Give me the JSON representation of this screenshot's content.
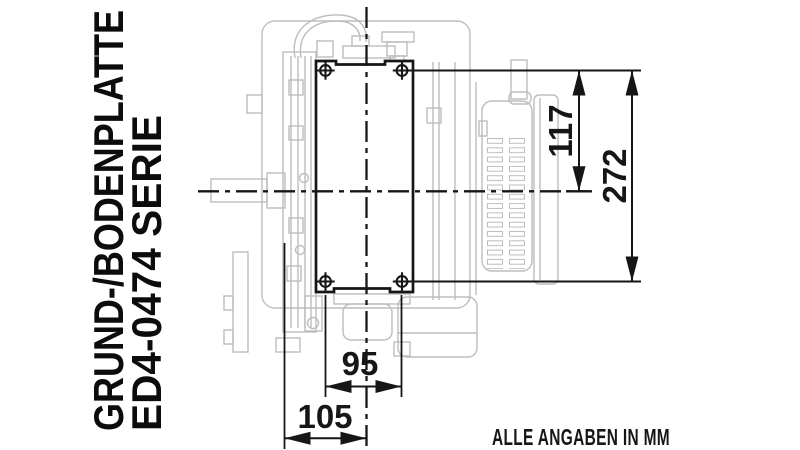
{
  "drawing_title": {
    "line1": "GRUND-/BODENPLATTE",
    "line2": "ED4-0474 SERIE"
  },
  "dimensions": {
    "bolt_top_to_crank_center": "117",
    "bolt_top_to_bolt_bottom": "272",
    "bolt_spacing_horizontal": "95",
    "housing_edge_to_center": "105"
  },
  "note": "ALLE ANGABEN IN MM",
  "colors": {
    "line": "#161616",
    "engine_outline": "#bdbdbd",
    "background": "#ffffff"
  }
}
